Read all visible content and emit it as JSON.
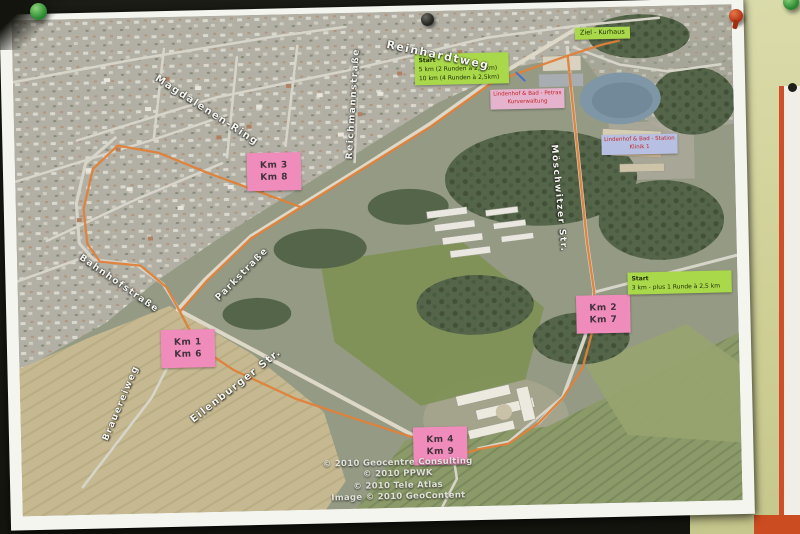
{
  "map": {
    "km_markers": [
      {
        "line1": "Km 3",
        "line2": "Km 8"
      },
      {
        "line1": "Km 1",
        "line2": "Km 6"
      },
      {
        "line1": "Km 2",
        "line2": "Km 7"
      },
      {
        "line1": "Km 4",
        "line2": "Km 9"
      }
    ],
    "start_marker_main": {
      "line1": "Start",
      "line2": "5 km (2 Runden à 2,5 km)",
      "line3": "10 km (4 Runden à 2,5km)"
    },
    "start_marker_east": {
      "line1": "Start",
      "line2": "3 km - plus 1 Runde à 2,5 km"
    },
    "finish_marker": {
      "text": "Ziel - Kurhaus"
    },
    "poi_markers": [
      {
        "line1": "Lindenhof & Bad - Petras",
        "line2": "Kurverwaltung"
      },
      {
        "line1": "Lindenhof & Bad - Station",
        "line2": "Klinik 1"
      }
    ],
    "streets": [
      {
        "name": "Reinhardtweg"
      },
      {
        "name": "Magdalenen-Ring"
      },
      {
        "name": "Reichmannstraße"
      },
      {
        "name": "Bahnhofstraße"
      },
      {
        "name": "Parkstraße"
      },
      {
        "name": "Eilenburger Str."
      },
      {
        "name": "Brauereiweg"
      },
      {
        "name": "Möschwitzer Str."
      }
    ],
    "copyright_lines": [
      "© 2010 Geocentre Consulting",
      "© 2010 PPWK",
      "© 2010 Tele Atlas",
      "Image © 2010 GeoContent"
    ],
    "colors": {
      "route": "#e0813a",
      "km_marker_bg": "#f08cbb",
      "start_marker_bg": "#a9d94a",
      "poi_marker_bg_1": "#e5b3cd",
      "poi_marker_bg_2": "#b7c0e2",
      "poi_marker_text": "#c42222",
      "board_bg": "#d5d6a0",
      "pin_green": "#2f8f35",
      "pin_red": "#b13414",
      "pin_black": "#23231f"
    }
  }
}
